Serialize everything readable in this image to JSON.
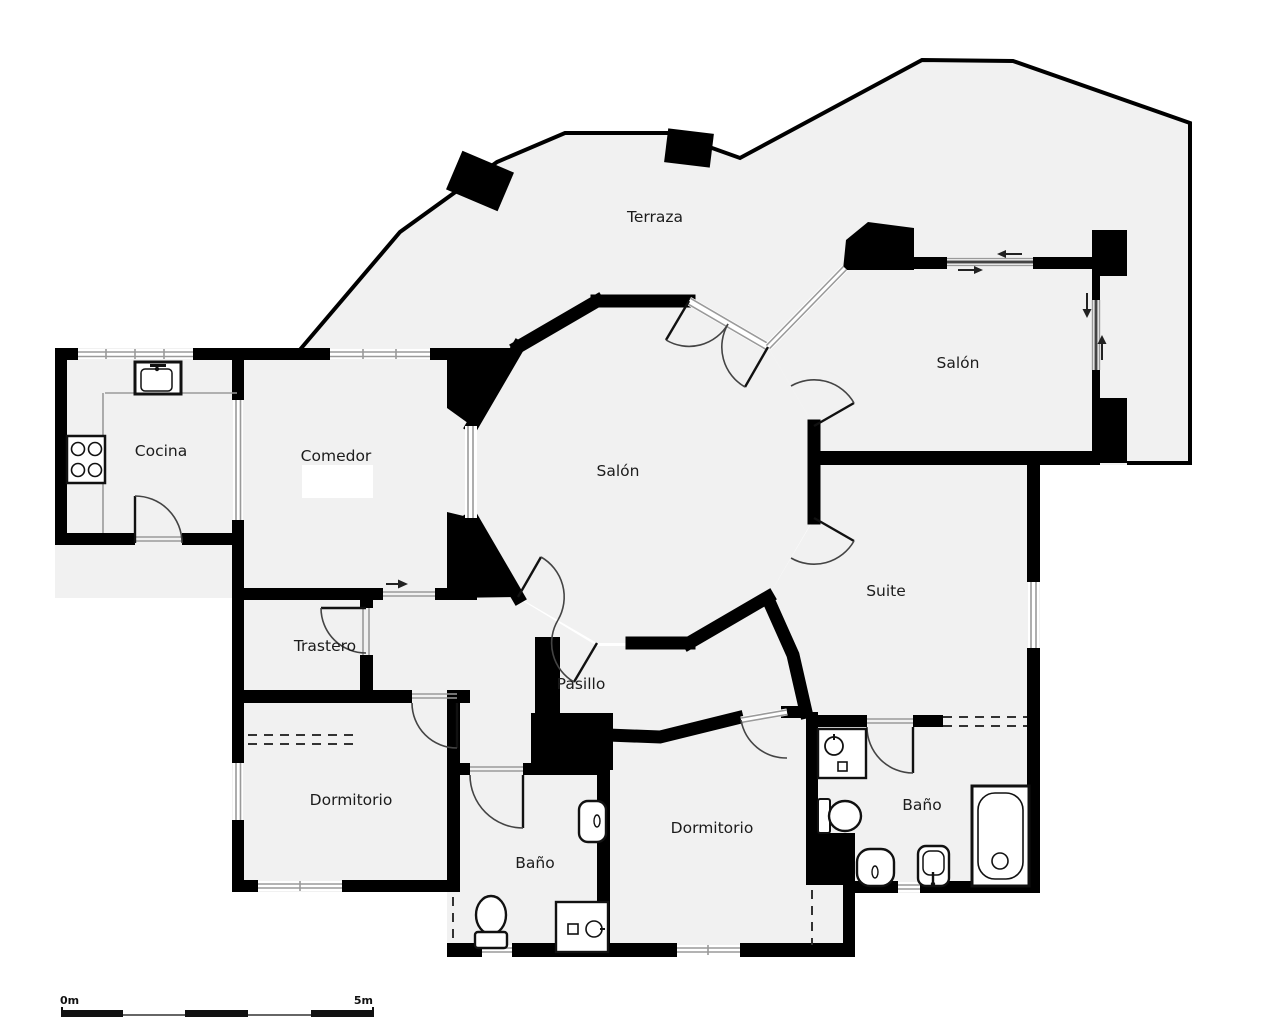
{
  "colors": {
    "floor": "#f1f1f1",
    "wall": "#000000",
    "glass": "#9a9a9a",
    "label": "#1c1c1c"
  },
  "labels": {
    "terraza": {
      "text": "Terraza",
      "x": 655,
      "y": 222
    },
    "salon_top": {
      "text": "Salón",
      "x": 958,
      "y": 368
    },
    "salon_center": {
      "text": "Salón",
      "x": 618,
      "y": 476
    },
    "cocina": {
      "text": "Cocina",
      "x": 161,
      "y": 456
    },
    "comedor": {
      "text": "Comedor",
      "x": 336,
      "y": 461
    },
    "suite": {
      "text": "Suite",
      "x": 886,
      "y": 596
    },
    "trastero": {
      "text": "Trastero",
      "x": 325,
      "y": 651
    },
    "pasillo": {
      "text": "Pasillo",
      "x": 581,
      "y": 689
    },
    "dormitorio_left": {
      "text": "Dormitorio",
      "x": 351,
      "y": 805
    },
    "dormitorio_center": {
      "text": "Dormitorio",
      "x": 712,
      "y": 833
    },
    "bano_left": {
      "text": "Baño",
      "x": 535,
      "y": 868
    },
    "bano_right": {
      "text": "Baño",
      "x": 922,
      "y": 810
    }
  },
  "scale_bar": {
    "start": "0m",
    "end": "5m"
  }
}
